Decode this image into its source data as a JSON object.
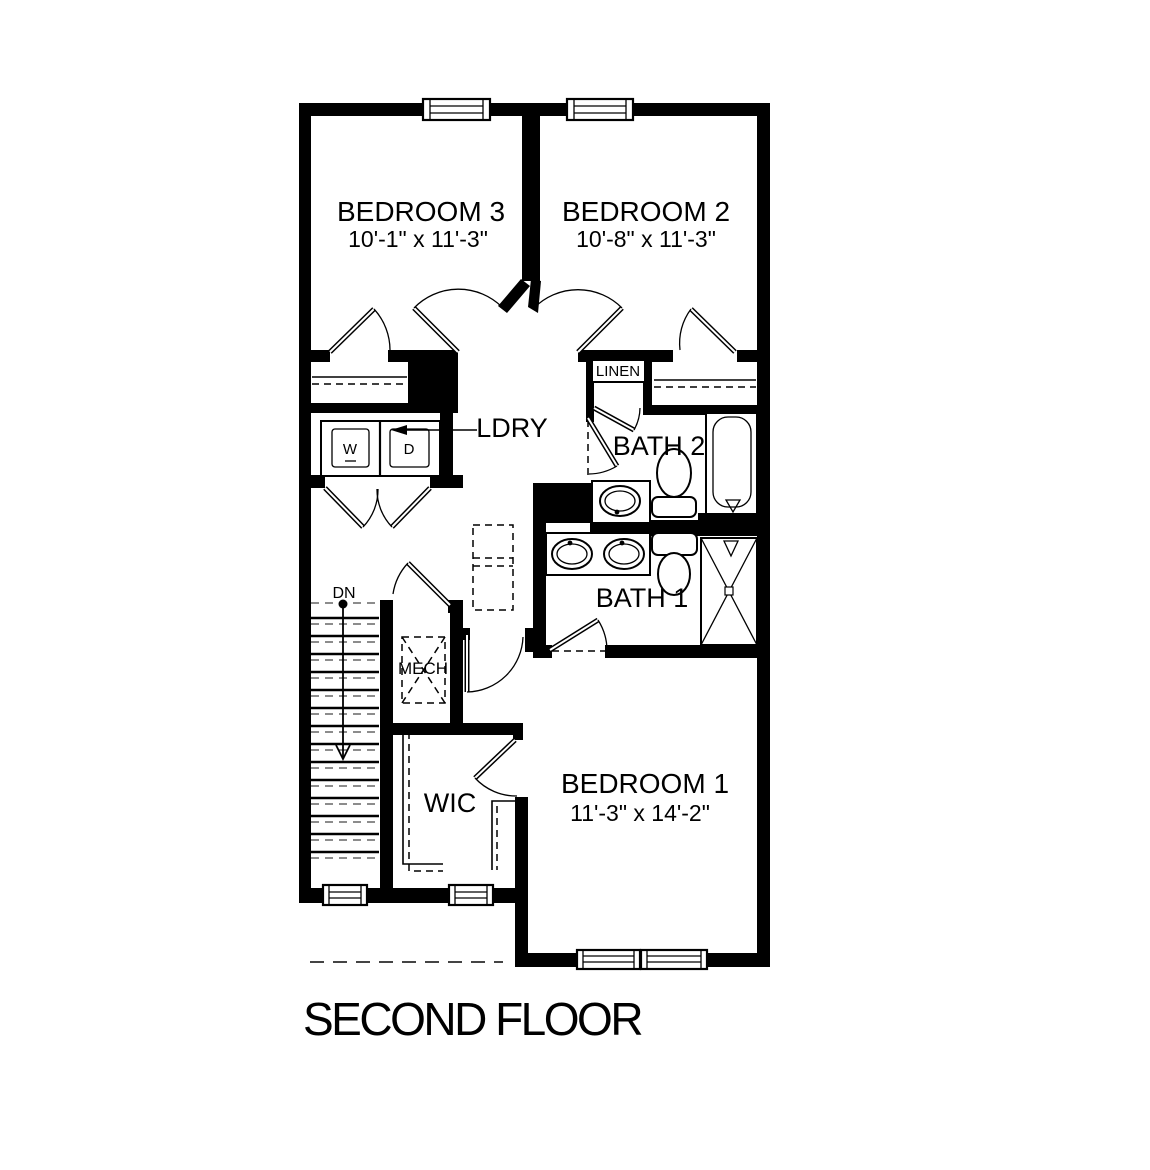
{
  "title": "SECOND FLOOR",
  "rooms": {
    "bedroom3": {
      "name": "BEDROOM 3",
      "dims": "10'-1\" x 11'-3\""
    },
    "bedroom2": {
      "name": "BEDROOM 2",
      "dims": "10'-8\" x 11'-3\""
    },
    "bedroom1": {
      "name": "BEDROOM 1",
      "dims": "11'-3\" x 14'-2\""
    },
    "bath2": {
      "name": "BATH 2"
    },
    "bath1": {
      "name": "BATH 1"
    },
    "laundry": {
      "name": "LDRY"
    },
    "wic": {
      "name": "WIC"
    },
    "mech": {
      "name": "MECH"
    },
    "linen": {
      "name": "LINEN"
    }
  },
  "stairs": {
    "down_label": "DN"
  },
  "appliances": {
    "washer": "W",
    "dryer": "D"
  },
  "colors": {
    "line": "#000000",
    "background": "#ffffff"
  }
}
